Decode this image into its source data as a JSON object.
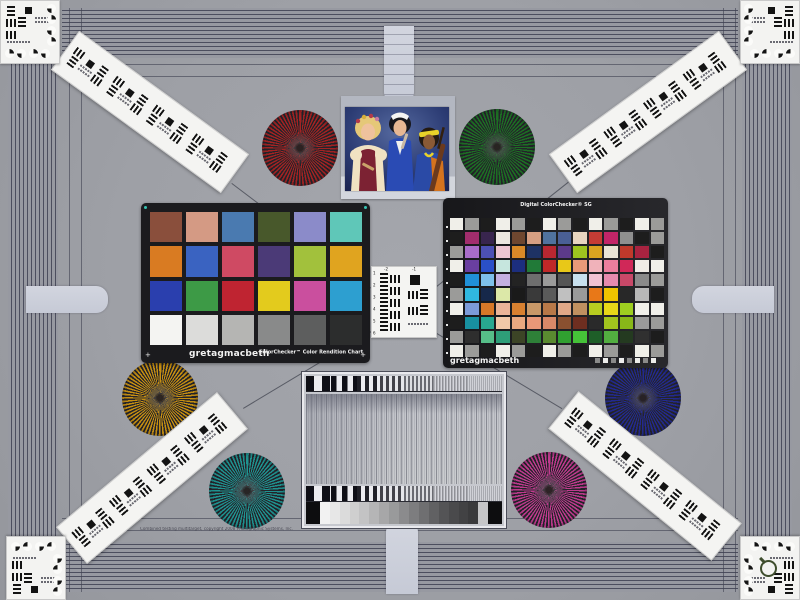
{
  "scene": {
    "name": "Camera multi-target laboratory test chart",
    "background": "#9ea0a6"
  },
  "palette": {
    "stripe_line": "#4c4e5e",
    "stripe_base": "#9799a1",
    "tab_gray": "#ccd0da",
    "card_white": "#f3f3f1",
    "chart_black": "#1b1b1e"
  },
  "labels": {
    "cc24_brand": "gretagmacbeth",
    "cc24_title": "ColorChecker™ Color Rendition Chart",
    "sg_title": "Digital ColorChecker® SG",
    "sg_brand": "gretagmacbeth",
    "copyright": "Combined testing multitarget, copyright 2008 Photographic Systems, Inc.",
    "usaf_numbers": [
      "-2",
      "-1",
      "1",
      "2",
      "3",
      "4",
      "5",
      "6"
    ]
  },
  "photo": {
    "alt": "Three women in folk costumes with musical instruments"
  },
  "colorchecker24": {
    "rows": 4,
    "cols": 6,
    "patches": [
      "#8a4f3c",
      "#d49a84",
      "#4a7ab0",
      "#48582b",
      "#8b8bc9",
      "#5fc7b8",
      "#d97b22",
      "#3a63c1",
      "#cf4a63",
      "#4b3a77",
      "#a2c13c",
      "#e0a41f",
      "#2a3fae",
      "#3d9a46",
      "#bf2431",
      "#e3cb1d",
      "#ca4f9e",
      "#2d9fd0",
      "#f4f4f2",
      "#dcdcda",
      "#b5b5b3",
      "#898a8a",
      "#5d5e5e",
      "#2c2d2d"
    ]
  },
  "colorchecker_sg": {
    "rows": 10,
    "cols": 14,
    "patches": [
      "#f0efe9",
      "#9b9b99",
      "#1d1d1d",
      "#f0efe9",
      "#9b9b99",
      "#1d1d1d",
      "#f0efe9",
      "#9b9b99",
      "#1d1d1d",
      "#f0efe9",
      "#9b9b99",
      "#1d1d1d",
      "#f0efe9",
      "#9b9b99",
      "#1d1d1d",
      "#a12d6d",
      "#38254e",
      "#ece7e0",
      "#6e4730",
      "#d69f83",
      "#50729e",
      "#4a5f95",
      "#e8d5c0",
      "#c43c35",
      "#c22568",
      "#8f8f8f",
      "#1d1d1d",
      "#9b9b99",
      "#9b9b99",
      "#a86cc8",
      "#4c50b4",
      "#eec6d2",
      "#d98a28",
      "#1e3264",
      "#b82731",
      "#5c3a8a",
      "#9ec41f",
      "#d9a520",
      "#e8e4d6",
      "#c0392b",
      "#a82340",
      "#1d1d1d",
      "#f0efe9",
      "#6a3fa0",
      "#2a50c8",
      "#c6e6de",
      "#1c2e7e",
      "#217a38",
      "#c02828",
      "#e8c818",
      "#e89a78",
      "#f0b2ba",
      "#ec7e9e",
      "#d02858",
      "#f0ece6",
      "#f0efe9",
      "#1d1d1d",
      "#2090d8",
      "#7ec0ea",
      "#c4b0e0",
      "#232323",
      "#6e6e6e",
      "#9a9a9a",
      "#555555",
      "#c8e0ee",
      "#f0c2d2",
      "#e68aae",
      "#c84868",
      "#8a8a8a",
      "#9b9b99",
      "#9b9b99",
      "#30b8e0",
      "#16284a",
      "#dce8a8",
      "#1a1a1a",
      "#3a3a3a",
      "#5a5a5a",
      "#c0c0c0",
      "#9a9a9a",
      "#e87818",
      "#f0c400",
      "#282828",
      "#b8b8b8",
      "#1d1d1d",
      "#f0efe9",
      "#7c9ad8",
      "#d87828",
      "#eab498",
      "#d88030",
      "#c89868",
      "#b87848",
      "#e0a888",
      "#c09060",
      "#b8cc20",
      "#e8d818",
      "#9ecf20",
      "#f0efe9",
      "#f0efe9",
      "#1d1d1d",
      "#1890a0",
      "#28a890",
      "#f0c8a8",
      "#e8a880",
      "#e89878",
      "#d88868",
      "#8a5030",
      "#6e2e20",
      "#2a2a2a",
      "#a2c41e",
      "#88b818",
      "#9a9a9a",
      "#9b9b99",
      "#9b9b99",
      "#2e2e2e",
      "#56be88",
      "#2e9e78",
      "#3c4426",
      "#2e8038",
      "#5a8a30",
      "#30a030",
      "#45c238",
      "#1e5e28",
      "#52ae40",
      "#243a20",
      "#303030",
      "#1d1d1d",
      "#f0efe9",
      "#9b9b99",
      "#1d1d1d",
      "#f0efe9",
      "#9b9b99",
      "#1d1d1d",
      "#f0efe9",
      "#9b9b99",
      "#1d1d1d",
      "#f0efe9",
      "#9b9b99",
      "#1d1d1d",
      "#f0efe9",
      "#9b9b99"
    ]
  },
  "siemens_stars": [
    {
      "name": "red",
      "color": "#a32323",
      "cx": 300,
      "cy": 148,
      "r": 38
    },
    {
      "name": "green",
      "color": "#1d7024",
      "cx": 497,
      "cy": 147,
      "r": 38
    },
    {
      "name": "amber",
      "color": "#c68f12",
      "cx": 160,
      "cy": 398,
      "r": 38
    },
    {
      "name": "navy",
      "color": "#232a90",
      "cx": 643,
      "cy": 398,
      "r": 38
    },
    {
      "name": "teal",
      "color": "#1f9390",
      "cx": 247,
      "cy": 491,
      "r": 38
    },
    {
      "name": "magenta",
      "color": "#bf3a8e",
      "cx": 549,
      "cy": 490,
      "r": 38
    }
  ],
  "step_wedge": [
    "#0d0d0f",
    "#f2f2f2",
    "#e7e7e7",
    "#dbdbdb",
    "#cfcfcf",
    "#c3c3c4",
    "#b5b5b6",
    "#a7a7a8",
    "#999a9b",
    "#8b8b8d",
    "#7d7d7f",
    "#6f6f71",
    "#616163",
    "#545456",
    "#4a4a4c",
    "#424244",
    "#3a3a3c",
    "#c6c6c8",
    "#0d0d0f"
  ],
  "sweep_segments": [
    {
      "w": 26,
      "p": 16,
      "o": 1
    },
    {
      "w": 26,
      "p": 11,
      "o": 1
    },
    {
      "w": 24,
      "p": 8,
      "o": 0.9
    },
    {
      "w": 24,
      "p": 6,
      "o": 0.72
    },
    {
      "w": 30,
      "p": 4,
      "o": 0.5
    },
    {
      "w": 34,
      "p": 3,
      "o": 0.3
    },
    {
      "w": 36,
      "p": 2,
      "o": 0.16
    }
  ]
}
